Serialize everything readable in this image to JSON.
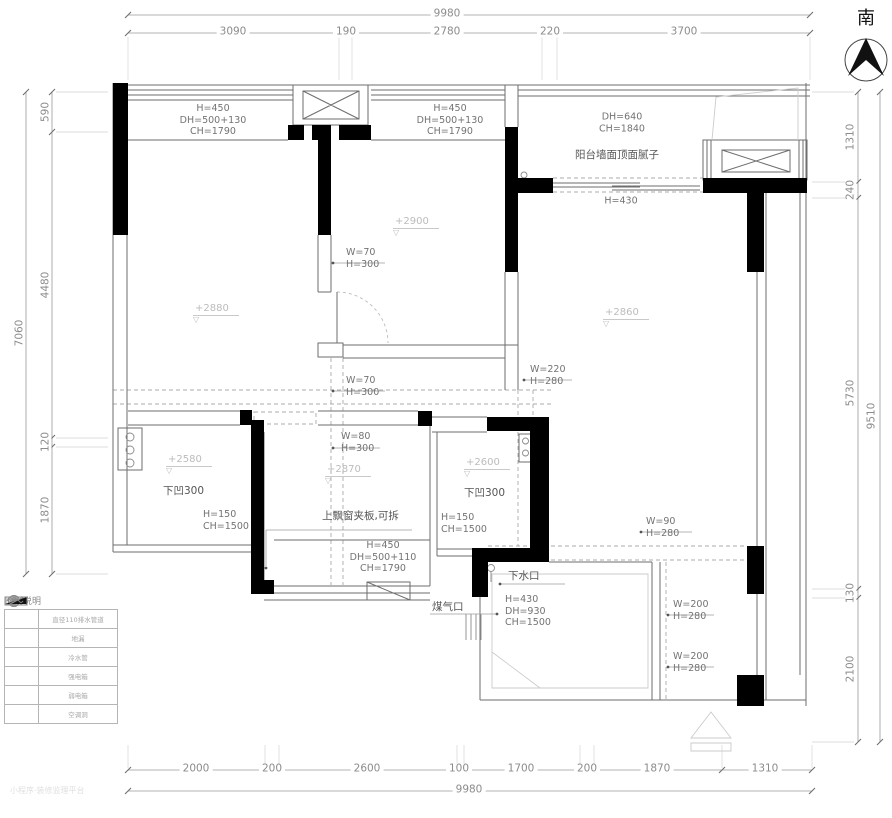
{
  "compass": {
    "direction_label": "南"
  },
  "dims": {
    "top": {
      "total": "9980",
      "segments": [
        "3090",
        "190",
        "2780",
        "220",
        "3700"
      ]
    },
    "bottom": {
      "total": "9980",
      "segments": [
        "2000",
        "200",
        "2600",
        "100",
        "1700",
        "200",
        "1870",
        "1310"
      ]
    },
    "left": {
      "total": "7060",
      "segments": [
        "590",
        "4480",
        "120",
        "1870"
      ]
    },
    "right": {
      "total": "9510",
      "segments": [
        "1310",
        "240",
        "5730",
        "130",
        "2100"
      ]
    }
  },
  "labels": {
    "win_tl": "H=450\nDH=500+130\nCH=1790",
    "win_tm": "H=450\nDH=500+130\nCH=1790",
    "balcony_dh": "DH=640\nCH=1840",
    "balcony_note": "阳台墙面顶面腻子",
    "balcony_h": "H=430",
    "beam_w70a": "W=70\nH=300",
    "beam_w70b": "W=70\nH=300",
    "beam_w220": "W=220\nH=280",
    "beam_w80": "W=80\nH=300",
    "beam_w90": "W=90\nH=280",
    "beam_w200a": "W=200\nH=280",
    "beam_w200b": "W=200\nH=280",
    "lvl_2880": "+2880",
    "lvl_2900": "+2900",
    "lvl_2860": "+2860",
    "lvl_2580": "+2580",
    "lvl_2870": "+2870",
    "lvl_2600": "+2600",
    "recess_a": "下凹300",
    "recess_b": "下凹300",
    "sill_a": "H=150\nCH=1500",
    "sill_b": "H=150\nCH=1500",
    "flip_window": "上飘窗夹板,可拆",
    "win_bm": "H=450\nDH=500+110\nCH=1790",
    "drain": "下水口",
    "gas": "煤气口",
    "bath_win": "H=430\nDH=930\nCH=1500"
  },
  "legend": {
    "title": "图例说明",
    "rows": [
      {
        "icon": "drain-pipe-symbol",
        "text": "直径110排水管道"
      },
      {
        "icon": "floor-drain-symbol",
        "text": "地漏"
      },
      {
        "icon": "cold-water-symbol",
        "text": "冷水管"
      },
      {
        "icon": "strong-power-symbol",
        "text": "强电箱"
      },
      {
        "icon": "weak-power-symbol",
        "text": "弱电箱"
      },
      {
        "icon": "ac-hole-symbol",
        "text": "空调洞"
      }
    ]
  },
  "watermark": "小程序·装修监理平台",
  "colors": {
    "wall": "#000000",
    "line": "#6e6e6e",
    "dash": "#a8a8a8",
    "dim": "#8c8c8c",
    "level": "#bcbcbc",
    "light": "#cccccc"
  }
}
